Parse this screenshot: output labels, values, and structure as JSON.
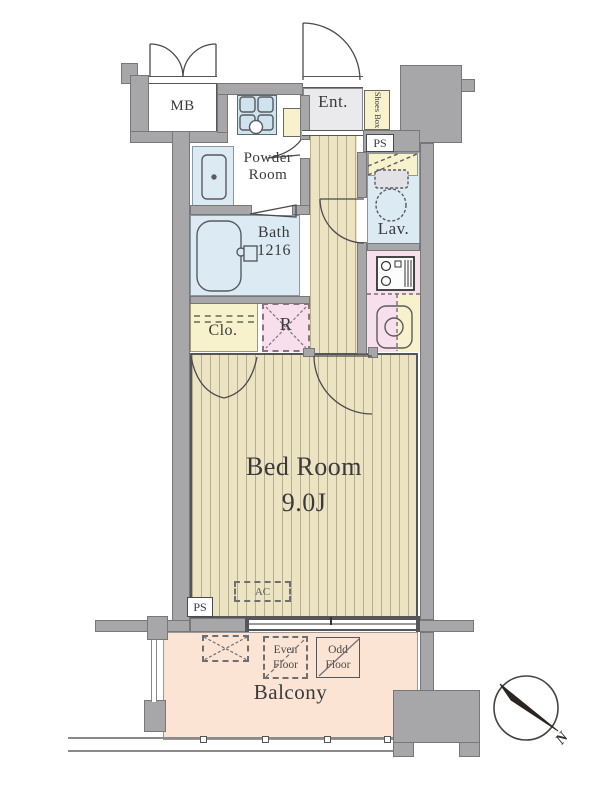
{
  "title": "apartment floor plan",
  "colors": {
    "wall": "#a7a7a9",
    "wallline": "#77777a",
    "line": "#55565a",
    "water": "#dcebf3",
    "yellow": "#f7f2cb",
    "pink": "#f7dfeb",
    "wood": "#ece3c2",
    "balconyfloor": "#fbe4d3",
    "entfloor": "#eaeaec"
  },
  "rooms": {
    "mb": {
      "label": "MB"
    },
    "entrance": {
      "label": "Ent."
    },
    "shoes_box": {
      "label": "Shoes Box"
    },
    "ps_upper": {
      "label": "PS"
    },
    "powder_room": {
      "label": "Powder Room"
    },
    "bath": {
      "label": "Bath",
      "size": "1216"
    },
    "lavatory": {
      "label": "Lav."
    },
    "closet": {
      "label": "Clo."
    },
    "refrigerator": {
      "label": "R"
    },
    "bedroom": {
      "label": "Bed Room",
      "size": "9.0J"
    },
    "ps_lower": {
      "label": "PS"
    },
    "balcony": {
      "label": "Balcony"
    }
  },
  "annotations": {
    "ac": "AC",
    "even_floor": "Even Floor",
    "odd_floor": "Odd Floor",
    "compass_north": "N"
  }
}
